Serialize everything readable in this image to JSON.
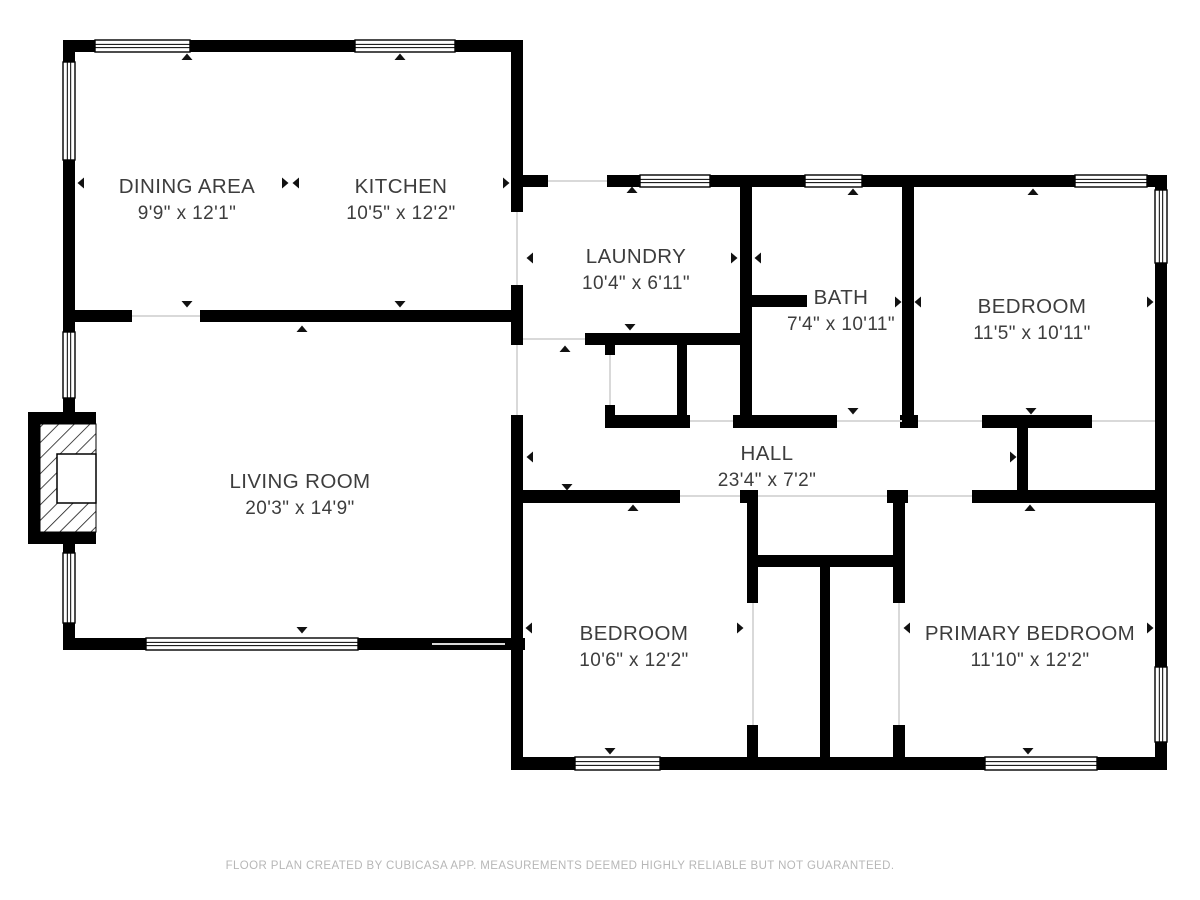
{
  "plan": {
    "canvas": {
      "width": 1200,
      "height": 900,
      "background": "#ffffff",
      "wall_color": "#000000",
      "opening_line_color": "#d9d9d9",
      "window_stroke_color": "#000000",
      "arrow_color": "#111111",
      "label_color": "#3d3d3d",
      "footer_color": "#b7b7b7"
    },
    "walls": [
      [
        63,
        40,
        460,
        12
      ],
      [
        63,
        40,
        12,
        384
      ],
      [
        63,
        532,
        12,
        118
      ],
      [
        63,
        638,
        462,
        12
      ],
      [
        75,
        310,
        57,
        12
      ],
      [
        200,
        310,
        323,
        12
      ],
      [
        511,
        40,
        12,
        172
      ],
      [
        511,
        285,
        12,
        60
      ],
      [
        511,
        415,
        12,
        355
      ],
      [
        523,
        175,
        25,
        12
      ],
      [
        607,
        175,
        560,
        12
      ],
      [
        1155,
        175,
        12,
        595
      ],
      [
        511,
        757,
        656,
        13
      ],
      [
        585,
        333,
        158,
        12
      ],
      [
        740,
        187,
        12,
        240
      ],
      [
        740,
        295,
        67,
        12
      ],
      [
        677,
        345,
        10,
        78
      ],
      [
        605,
        345,
        10,
        10
      ],
      [
        605,
        405,
        10,
        10
      ],
      [
        605,
        415,
        85,
        13
      ],
      [
        733,
        415,
        104,
        13
      ],
      [
        900,
        415,
        18,
        13
      ],
      [
        982,
        415,
        110,
        13
      ],
      [
        902,
        187,
        12,
        228
      ],
      [
        1017,
        428,
        11,
        64
      ],
      [
        523,
        490,
        157,
        13
      ],
      [
        740,
        490,
        18,
        13
      ],
      [
        887,
        490,
        21,
        13
      ],
      [
        972,
        490,
        186,
        13
      ],
      [
        753,
        555,
        144,
        12
      ],
      [
        820,
        567,
        10,
        190
      ],
      [
        747,
        503,
        11,
        100
      ],
      [
        747,
        725,
        11,
        32
      ],
      [
        893,
        503,
        12,
        100
      ],
      [
        893,
        725,
        12,
        32
      ]
    ],
    "windows": [
      [
        95,
        40,
        95,
        12
      ],
      [
        355,
        40,
        100,
        12
      ],
      [
        146,
        638,
        212,
        12
      ],
      [
        640,
        175,
        70,
        12
      ],
      [
        805,
        175,
        57,
        12
      ],
      [
        1075,
        175,
        72,
        12
      ],
      [
        575,
        757,
        85,
        13
      ],
      [
        985,
        757,
        112,
        13
      ],
      [
        63,
        62,
        12,
        98
      ],
      [
        63,
        332,
        12,
        66
      ],
      [
        63,
        553,
        12,
        70
      ],
      [
        1155,
        190,
        12,
        73
      ],
      [
        1155,
        667,
        12,
        75
      ]
    ],
    "openings": [
      [
        132,
        315,
        68,
        2
      ],
      [
        516,
        212,
        2,
        73
      ],
      [
        516,
        345,
        2,
        70
      ],
      [
        432,
        643,
        73,
        2
      ],
      [
        548,
        180,
        59,
        2
      ],
      [
        523,
        338,
        62,
        2
      ],
      [
        609,
        355,
        2,
        50
      ],
      [
        690,
        420,
        43,
        2
      ],
      [
        837,
        420,
        65,
        2
      ],
      [
        918,
        420,
        64,
        2
      ],
      [
        1092,
        420,
        63,
        2
      ],
      [
        680,
        495,
        60,
        2
      ],
      [
        758,
        495,
        129,
        2
      ],
      [
        908,
        495,
        64,
        2
      ],
      [
        752,
        603,
        2,
        122
      ],
      [
        898,
        603,
        2,
        122
      ]
    ],
    "stoop": {
      "frame": [
        28,
        412,
        68,
        132
      ],
      "hatch": [
        40,
        424,
        56,
        108
      ],
      "landing": [
        57,
        454,
        39,
        49
      ]
    },
    "arrows": {
      "up": [
        [
          187,
          57
        ],
        [
          400,
          57
        ],
        [
          302,
          329
        ],
        [
          632,
          190
        ],
        [
          853,
          192
        ],
        [
          1033,
          192
        ],
        [
          565,
          349
        ],
        [
          633,
          508
        ],
        [
          1030,
          508
        ]
      ],
      "down": [
        [
          187,
          304
        ],
        [
          400,
          304
        ],
        [
          302,
          630
        ],
        [
          630,
          327
        ],
        [
          853,
          411
        ],
        [
          1031,
          411
        ],
        [
          567,
          487
        ],
        [
          610,
          751
        ],
        [
          1028,
          751
        ]
      ],
      "left": [
        [
          81,
          183
        ],
        [
          296,
          183
        ],
        [
          530,
          258
        ],
        [
          758,
          258
        ],
        [
          918,
          302
        ],
        [
          530,
          457
        ],
        [
          529,
          628
        ],
        [
          907,
          628
        ]
      ],
      "right": [
        [
          285,
          183
        ],
        [
          506,
          183
        ],
        [
          734,
          258
        ],
        [
          898,
          302
        ],
        [
          1150,
          302
        ],
        [
          1013,
          457
        ],
        [
          740,
          628
        ],
        [
          1150,
          628
        ]
      ]
    },
    "rooms": [
      {
        "name": "DINING AREA",
        "dims": "9'9\" x 12'1\"",
        "cx": 187,
        "cy": 186
      },
      {
        "name": "KITCHEN",
        "dims": "10'5\" x 12'2\"",
        "cx": 401,
        "cy": 186
      },
      {
        "name": "LAUNDRY",
        "dims": "10'4\" x 6'11\"",
        "cx": 636,
        "cy": 256
      },
      {
        "name": "BATH",
        "dims": "7'4\" x 10'11\"",
        "cx": 841,
        "cy": 297
      },
      {
        "name": "BEDROOM",
        "dims": "11'5\" x 10'11\"",
        "cx": 1032,
        "cy": 306
      },
      {
        "name": "LIVING ROOM",
        "dims": "20'3\" x 14'9\"",
        "cx": 300,
        "cy": 481
      },
      {
        "name": "HALL",
        "dims": "23'4\" x 7'2\"",
        "cx": 767,
        "cy": 453
      },
      {
        "name": "BEDROOM",
        "dims": "10'6\" x 12'2\"",
        "cx": 634,
        "cy": 633
      },
      {
        "name": "PRIMARY BEDROOM",
        "dims": "11'10\" x 12'2\"",
        "cx": 1030,
        "cy": 633
      }
    ],
    "footer": {
      "text": "FLOOR PLAN CREATED BY CUBICASA APP. MEASUREMENTS DEEMED HIGHLY RELIABLE BUT NOT GUARANTEED."
    }
  }
}
